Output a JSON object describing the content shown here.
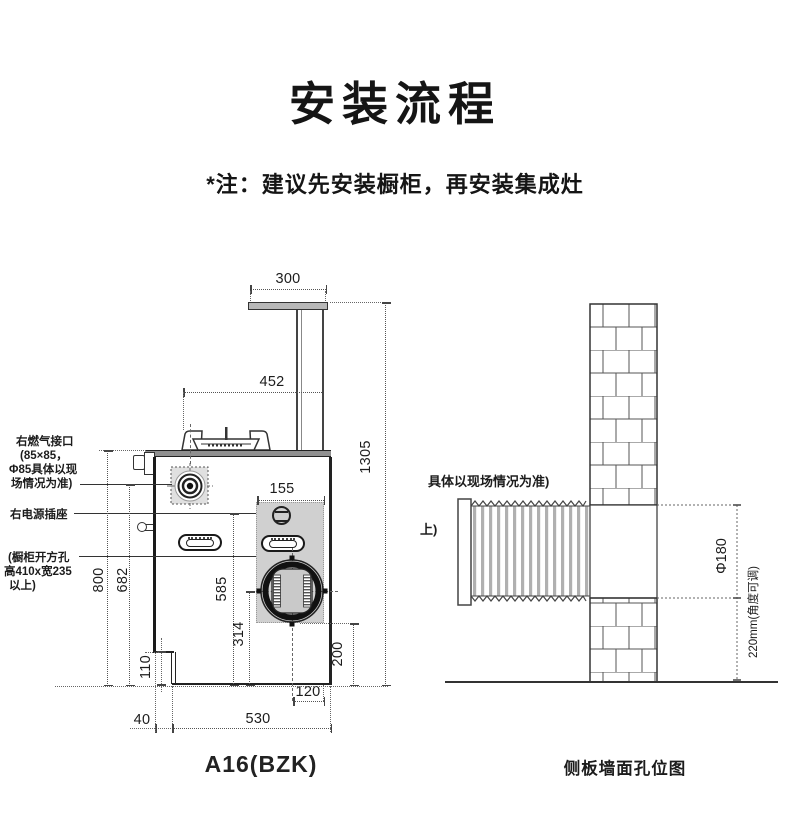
{
  "page": {
    "title": "安装流程",
    "note": "*注：建议先安装橱柜，再安装集成灶"
  },
  "left": {
    "caption": "A16(BZK)",
    "gas_label": [
      "右燃气接口",
      "(85×85，",
      "Φ85具体以现",
      "场情况为准)"
    ],
    "socket_label": "右电源插座",
    "cabinet_label": [
      "(橱柜开方孔",
      "高410x宽235",
      "以上)"
    ],
    "dims": {
      "d300": "300",
      "d452": "452",
      "d1305": "1305",
      "d155": "155",
      "d800": "800",
      "d682": "682",
      "d585": "585",
      "d314": "314",
      "d110": "110",
      "d200": "200",
      "d120": "120",
      "d40": "40",
      "d530": "530"
    }
  },
  "right": {
    "caption": "侧板墙面孔位图",
    "note_line1": "具体以现场情况为准)",
    "note_line2": "上)",
    "hole_dia": "Φ180",
    "duct_dim": "220mm(角度可调)"
  }
}
